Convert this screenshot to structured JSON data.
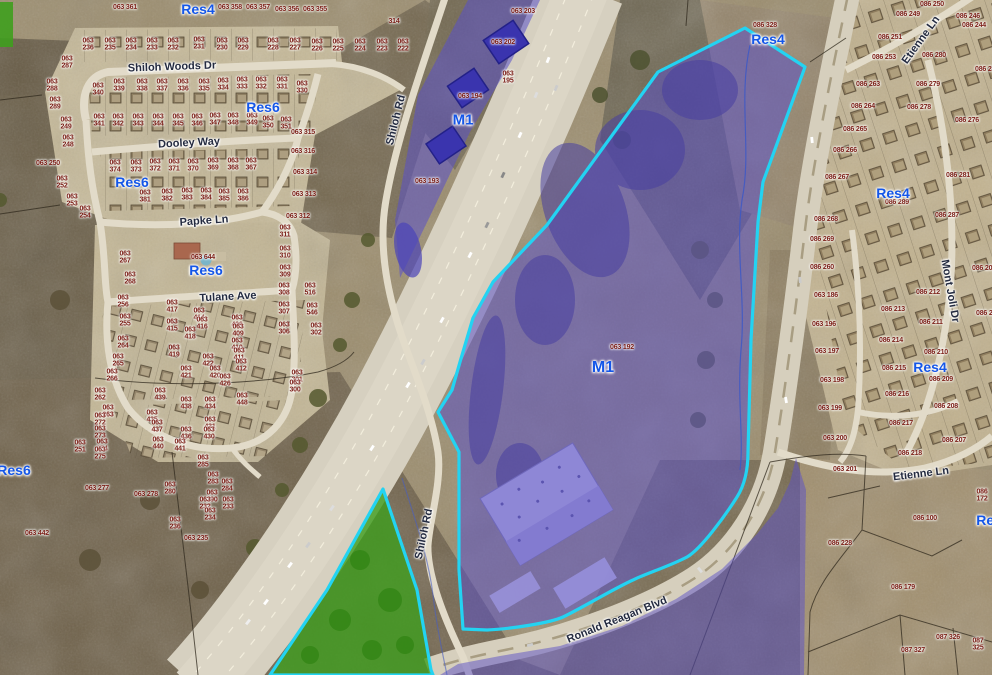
{
  "title": "Aerial parcel zoning map",
  "colors": {
    "selection_outline": "#23d3f2",
    "industrial_overlay": "#5a50c8",
    "greenspace_overlay": "#3f9e1e",
    "zone_label_blue": "#1456e8",
    "parcel_label_red": "#7c2018",
    "street_label_navy": "#242b40"
  },
  "map": {
    "zone_labels": [
      {
        "label": "Res4",
        "x": 198,
        "y": 9
      },
      {
        "label": "Res6",
        "x": 263,
        "y": 107
      },
      {
        "label": "Res6",
        "x": 132,
        "y": 182
      },
      {
        "label": "Res6",
        "x": 206,
        "y": 270
      },
      {
        "label": "Res6",
        "x": 14,
        "y": 470
      },
      {
        "label": "Res4",
        "x": 768,
        "y": 39
      },
      {
        "label": "Res4",
        "x": 893,
        "y": 193
      },
      {
        "label": "Res4",
        "x": 930,
        "y": 367
      },
      {
        "label": "Res4",
        "x": 993,
        "y": 520
      },
      {
        "label": "M1",
        "x": 463,
        "y": 120,
        "s": 15
      },
      {
        "label": "M1",
        "x": 603,
        "y": 368,
        "s": 16
      }
    ],
    "street_labels": [
      {
        "name": "Shiloh Woods Dr",
        "x": 172,
        "y": 67,
        "rot": -2
      },
      {
        "name": "Dooley Way",
        "x": 189,
        "y": 143,
        "rot": -3
      },
      {
        "name": "Papke Ln",
        "x": 204,
        "y": 221,
        "rot": -4
      },
      {
        "name": "Tulane Ave",
        "x": 228,
        "y": 297,
        "rot": -3
      },
      {
        "name": "Shiloh Rd",
        "x": 396,
        "y": 120,
        "rot": -76
      },
      {
        "name": "Shiloh Rd",
        "x": 424,
        "y": 534,
        "rot": -78
      },
      {
        "name": "Ronald Reagan Blvd",
        "x": 617,
        "y": 620,
        "rot": -22
      },
      {
        "name": "Etienne Ln",
        "x": 921,
        "y": 40,
        "rot": -54
      },
      {
        "name": "Etienne Ln",
        "x": 921,
        "y": 474,
        "rot": -7
      },
      {
        "name": "Mont Joli Dr",
        "x": 950,
        "y": 291,
        "rot": 80
      }
    ],
    "parcel_labels": [
      {
        "id": "063 361",
        "x": 125,
        "y": 8
      },
      {
        "id": "063 358",
        "x": 230,
        "y": 8
      },
      {
        "id": "063 357",
        "x": 258,
        "y": 8
      },
      {
        "id": "063 356",
        "x": 287,
        "y": 10
      },
      {
        "id": "063 355",
        "x": 315,
        "y": 10
      },
      {
        "id": "314",
        "x": 394,
        "y": 22
      },
      {
        "id": "063 203",
        "x": 523,
        "y": 12
      },
      {
        "id": "063 236",
        "x": 88,
        "y": 45,
        "w": 1
      },
      {
        "id": "063 235",
        "x": 110,
        "y": 45,
        "w": 1
      },
      {
        "id": "063 234",
        "x": 131,
        "y": 45,
        "w": 1
      },
      {
        "id": "063 233",
        "x": 152,
        "y": 45,
        "w": 1
      },
      {
        "id": "063 232",
        "x": 173,
        "y": 45,
        "w": 1
      },
      {
        "id": "063 231",
        "x": 199,
        "y": 44,
        "w": 1
      },
      {
        "id": "063 230",
        "x": 222,
        "y": 45,
        "w": 1
      },
      {
        "id": "063 229",
        "x": 243,
        "y": 45,
        "w": 1
      },
      {
        "id": "063 228",
        "x": 273,
        "y": 45,
        "w": 1
      },
      {
        "id": "063 227",
        "x": 295,
        "y": 45,
        "w": 1
      },
      {
        "id": "063 226",
        "x": 317,
        "y": 46,
        "w": 1
      },
      {
        "id": "063 225",
        "x": 338,
        "y": 46,
        "w": 1
      },
      {
        "id": "063 224",
        "x": 360,
        "y": 46,
        "w": 1
      },
      {
        "id": "063 223",
        "x": 382,
        "y": 46,
        "w": 1
      },
      {
        "id": "063 222",
        "x": 403,
        "y": 46,
        "w": 1
      },
      {
        "id": "063 315",
        "x": 303,
        "y": 133
      },
      {
        "id": "063 316",
        "x": 303,
        "y": 152
      },
      {
        "id": "063 314",
        "x": 305,
        "y": 173
      },
      {
        "id": "063 313",
        "x": 304,
        "y": 195
      },
      {
        "id": "063 312",
        "x": 298,
        "y": 217
      },
      {
        "id": "063 340",
        "x": 98,
        "y": 90,
        "w": 1
      },
      {
        "id": "063 339",
        "x": 119,
        "y": 86,
        "w": 1
      },
      {
        "id": "063 338",
        "x": 142,
        "y": 86,
        "w": 1
      },
      {
        "id": "063 337",
        "x": 162,
        "y": 86,
        "w": 1
      },
      {
        "id": "063 336",
        "x": 183,
        "y": 86,
        "w": 1
      },
      {
        "id": "063 335",
        "x": 204,
        "y": 86,
        "w": 1
      },
      {
        "id": "063 334",
        "x": 223,
        "y": 85,
        "w": 1
      },
      {
        "id": "063 333",
        "x": 242,
        "y": 84,
        "w": 1
      },
      {
        "id": "063 332",
        "x": 261,
        "y": 84,
        "w": 1
      },
      {
        "id": "063 331",
        "x": 282,
        "y": 84,
        "w": 1
      },
      {
        "id": "063 330",
        "x": 302,
        "y": 88,
        "w": 1
      },
      {
        "id": "063 341",
        "x": 99,
        "y": 121,
        "w": 1
      },
      {
        "id": "063 342",
        "x": 118,
        "y": 121,
        "w": 1
      },
      {
        "id": "063 343",
        "x": 138,
        "y": 121,
        "w": 1
      },
      {
        "id": "063 344",
        "x": 158,
        "y": 121,
        "w": 1
      },
      {
        "id": "063 345",
        "x": 178,
        "y": 121,
        "w": 1
      },
      {
        "id": "063 346",
        "x": 197,
        "y": 121,
        "w": 1
      },
      {
        "id": "063 347",
        "x": 215,
        "y": 120,
        "w": 1
      },
      {
        "id": "063 348",
        "x": 233,
        "y": 120,
        "w": 1
      },
      {
        "id": "063 349",
        "x": 252,
        "y": 120,
        "w": 1
      },
      {
        "id": "063 350",
        "x": 268,
        "y": 123,
        "w": 1
      },
      {
        "id": "063 351",
        "x": 286,
        "y": 124,
        "w": 1
      },
      {
        "id": "063 374",
        "x": 115,
        "y": 167,
        "w": 1
      },
      {
        "id": "063 373",
        "x": 136,
        "y": 167,
        "w": 1
      },
      {
        "id": "063 372",
        "x": 155,
        "y": 166,
        "w": 1
      },
      {
        "id": "063 371",
        "x": 174,
        "y": 166,
        "w": 1
      },
      {
        "id": "063 370",
        "x": 193,
        "y": 166,
        "w": 1
      },
      {
        "id": "063 369",
        "x": 213,
        "y": 165,
        "w": 1
      },
      {
        "id": "063 368",
        "x": 233,
        "y": 165,
        "w": 1
      },
      {
        "id": "063 367",
        "x": 251,
        "y": 165,
        "w": 1
      },
      {
        "id": "063 381",
        "x": 145,
        "y": 197,
        "w": 1
      },
      {
        "id": "063 382",
        "x": 167,
        "y": 196,
        "w": 1
      },
      {
        "id": "063 383",
        "x": 187,
        "y": 195,
        "w": 1
      },
      {
        "id": "063 384",
        "x": 206,
        "y": 195,
        "w": 1
      },
      {
        "id": "063 385",
        "x": 224,
        "y": 196,
        "w": 1
      },
      {
        "id": "063 386",
        "x": 243,
        "y": 196,
        "w": 1
      },
      {
        "id": "063 287",
        "x": 67,
        "y": 63,
        "w": 1
      },
      {
        "id": "063 288",
        "x": 52,
        "y": 86,
        "w": 1
      },
      {
        "id": "063 289",
        "x": 55,
        "y": 104,
        "w": 1
      },
      {
        "id": "063 249",
        "x": 66,
        "y": 124,
        "w": 1
      },
      {
        "id": "063 248",
        "x": 68,
        "y": 142,
        "w": 1
      },
      {
        "id": "063 250",
        "x": 48,
        "y": 164
      },
      {
        "id": "063 252",
        "x": 62,
        "y": 183,
        "w": 1
      },
      {
        "id": "063 253",
        "x": 72,
        "y": 201,
        "w": 1
      },
      {
        "id": "063 254",
        "x": 85,
        "y": 213,
        "w": 1
      },
      {
        "id": "063 644",
        "x": 203,
        "y": 258
      },
      {
        "id": "063 311",
        "x": 285,
        "y": 232,
        "w": 1
      },
      {
        "id": "063 310",
        "x": 285,
        "y": 253,
        "w": 1
      },
      {
        "id": "063 309",
        "x": 285,
        "y": 272,
        "w": 1
      },
      {
        "id": "063 308",
        "x": 284,
        "y": 290,
        "w": 1
      },
      {
        "id": "063 307",
        "x": 284,
        "y": 309,
        "w": 1
      },
      {
        "id": "063 306",
        "x": 284,
        "y": 329,
        "w": 1
      },
      {
        "id": "063 516",
        "x": 310,
        "y": 290,
        "w": 1
      },
      {
        "id": "063 546",
        "x": 312,
        "y": 310,
        "w": 1
      },
      {
        "id": "063 302",
        "x": 316,
        "y": 330,
        "w": 1
      },
      {
        "id": "063 301",
        "x": 297,
        "y": 377,
        "w": 1
      },
      {
        "id": "063 300",
        "x": 295,
        "y": 387,
        "w": 1
      },
      {
        "id": "063 267",
        "x": 125,
        "y": 258,
        "w": 1
      },
      {
        "id": "063 268",
        "x": 130,
        "y": 279,
        "w": 1
      },
      {
        "id": "063 256",
        "x": 123,
        "y": 302,
        "w": 1
      },
      {
        "id": "063 255",
        "x": 125,
        "y": 321,
        "w": 1
      },
      {
        "id": "063 264",
        "x": 123,
        "y": 343,
        "w": 1
      },
      {
        "id": "063 265",
        "x": 118,
        "y": 361,
        "w": 1
      },
      {
        "id": "063 266",
        "x": 112,
        "y": 376,
        "w": 1
      },
      {
        "id": "063 417",
        "x": 172,
        "y": 307,
        "w": 1
      },
      {
        "id": "063 414",
        "x": 199,
        "y": 315,
        "w": 1
      },
      {
        "id": "063 415",
        "x": 172,
        "y": 326,
        "w": 1
      },
      {
        "id": "063 416",
        "x": 202,
        "y": 324,
        "w": 1
      },
      {
        "id": "063 418",
        "x": 190,
        "y": 334,
        "w": 1
      },
      {
        "id": "063 406",
        "x": 237,
        "y": 322,
        "w": 1
      },
      {
        "id": "063 409",
        "x": 238,
        "y": 331,
        "w": 1
      },
      {
        "id": "063 410",
        "x": 237,
        "y": 345,
        "w": 1
      },
      {
        "id": "063 411",
        "x": 239,
        "y": 355,
        "w": 1
      },
      {
        "id": "063 412",
        "x": 241,
        "y": 366,
        "w": 1
      },
      {
        "id": "063 419",
        "x": 174,
        "y": 352,
        "w": 1
      },
      {
        "id": "063 422",
        "x": 208,
        "y": 361,
        "w": 1
      },
      {
        "id": "063 421",
        "x": 186,
        "y": 373,
        "w": 1
      },
      {
        "id": "063 420",
        "x": 215,
        "y": 373,
        "w": 1
      },
      {
        "id": "063 426",
        "x": 225,
        "y": 381,
        "w": 1
      },
      {
        "id": "063 439",
        "x": 160,
        "y": 395,
        "w": 1
      },
      {
        "id": "063 438",
        "x": 186,
        "y": 404,
        "w": 1
      },
      {
        "id": "063 434",
        "x": 210,
        "y": 404,
        "w": 1
      },
      {
        "id": "063 448",
        "x": 242,
        "y": 400,
        "w": 1
      },
      {
        "id": "063 435",
        "x": 152,
        "y": 417,
        "w": 1
      },
      {
        "id": "063 431",
        "x": 210,
        "y": 424,
        "w": 1
      },
      {
        "id": "063 437",
        "x": 157,
        "y": 427,
        "w": 1
      },
      {
        "id": "063 436",
        "x": 186,
        "y": 434,
        "w": 1
      },
      {
        "id": "063 430",
        "x": 209,
        "y": 434,
        "w": 1
      },
      {
        "id": "063 440",
        "x": 158,
        "y": 444,
        "w": 1
      },
      {
        "id": "063 441",
        "x": 180,
        "y": 446,
        "w": 1
      },
      {
        "id": "063 262",
        "x": 100,
        "y": 395,
        "w": 1
      },
      {
        "id": "063 263",
        "x": 108,
        "y": 412,
        "w": 1
      },
      {
        "id": "063 272",
        "x": 100,
        "y": 420,
        "w": 1
      },
      {
        "id": "063 273",
        "x": 100,
        "y": 433,
        "w": 1
      },
      {
        "id": "063 274",
        "x": 102,
        "y": 446,
        "w": 1
      },
      {
        "id": "063 251",
        "x": 80,
        "y": 447,
        "w": 1
      },
      {
        "id": "063 275",
        "x": 100,
        "y": 454,
        "w": 1
      },
      {
        "id": "063 277",
        "x": 97,
        "y": 489
      },
      {
        "id": "063 278",
        "x": 146,
        "y": 495
      },
      {
        "id": "063 280",
        "x": 170,
        "y": 489,
        "w": 1
      },
      {
        "id": "063 285",
        "x": 203,
        "y": 462,
        "w": 1
      },
      {
        "id": "063 283",
        "x": 213,
        "y": 479,
        "w": 1
      },
      {
        "id": "063 284",
        "x": 227,
        "y": 486,
        "w": 1
      },
      {
        "id": "063 290",
        "x": 212,
        "y": 497,
        "w": 1
      },
      {
        "id": "063 232",
        "x": 205,
        "y": 504,
        "w": 1
      },
      {
        "id": "063 233",
        "x": 228,
        "y": 504,
        "w": 1
      },
      {
        "id": "063 234",
        "x": 210,
        "y": 515,
        "w": 1
      },
      {
        "id": "063 235",
        "x": 196,
        "y": 539
      },
      {
        "id": "063 236",
        "x": 175,
        "y": 524,
        "w": 1
      },
      {
        "id": "063 442",
        "x": 37,
        "y": 534
      },
      {
        "id": "063 202",
        "x": 503,
        "y": 43
      },
      {
        "id": "063 195",
        "x": 508,
        "y": 78,
        "w": 1
      },
      {
        "id": "063 194",
        "x": 470,
        "y": 97
      },
      {
        "id": "063 193",
        "x": 427,
        "y": 182
      },
      {
        "id": "063 192",
        "x": 622,
        "y": 348
      },
      {
        "id": "086 328",
        "x": 765,
        "y": 26
      },
      {
        "id": "086 251",
        "x": 890,
        "y": 38
      },
      {
        "id": "086 253",
        "x": 884,
        "y": 58
      },
      {
        "id": "086 263",
        "x": 868,
        "y": 85
      },
      {
        "id": "086 264",
        "x": 863,
        "y": 107
      },
      {
        "id": "086 265",
        "x": 855,
        "y": 130
      },
      {
        "id": "086 266",
        "x": 845,
        "y": 151
      },
      {
        "id": "086 267",
        "x": 837,
        "y": 178
      },
      {
        "id": "086 268",
        "x": 826,
        "y": 220
      },
      {
        "id": "086 280",
        "x": 934,
        "y": 56
      },
      {
        "id": "086 279",
        "x": 928,
        "y": 85
      },
      {
        "id": "086 278",
        "x": 919,
        "y": 108
      },
      {
        "id": "086 276",
        "x": 967,
        "y": 121
      },
      {
        "id": "086 281",
        "x": 958,
        "y": 176
      },
      {
        "id": "086 289",
        "x": 897,
        "y": 203
      },
      {
        "id": "086 287",
        "x": 947,
        "y": 216
      },
      {
        "id": "086 250",
        "x": 932,
        "y": 5
      },
      {
        "id": "086 249",
        "x": 908,
        "y": 15
      },
      {
        "id": "086 246",
        "x": 968,
        "y": 17
      },
      {
        "id": "086 244",
        "x": 974,
        "y": 26
      },
      {
        "id": "086 245",
        "x": 987,
        "y": 70
      },
      {
        "id": "086 269",
        "x": 822,
        "y": 240
      },
      {
        "id": "086 260",
        "x": 822,
        "y": 268
      },
      {
        "id": "063 186",
        "x": 826,
        "y": 296
      },
      {
        "id": "063 196",
        "x": 824,
        "y": 325
      },
      {
        "id": "063 197",
        "x": 827,
        "y": 352
      },
      {
        "id": "063 198",
        "x": 832,
        "y": 381
      },
      {
        "id": "063 199",
        "x": 830,
        "y": 409
      },
      {
        "id": "063 200",
        "x": 835,
        "y": 439
      },
      {
        "id": "086 213",
        "x": 893,
        "y": 310
      },
      {
        "id": "086 212",
        "x": 928,
        "y": 293
      },
      {
        "id": "086 211",
        "x": 931,
        "y": 323
      },
      {
        "id": "086 214",
        "x": 891,
        "y": 341
      },
      {
        "id": "086 210",
        "x": 936,
        "y": 353
      },
      {
        "id": "086 215",
        "x": 894,
        "y": 369
      },
      {
        "id": "086 209",
        "x": 941,
        "y": 380
      },
      {
        "id": "086 216",
        "x": 897,
        "y": 395
      },
      {
        "id": "086 208",
        "x": 946,
        "y": 407
      },
      {
        "id": "086 217",
        "x": 901,
        "y": 424
      },
      {
        "id": "086 207",
        "x": 954,
        "y": 441
      },
      {
        "id": "086 205",
        "x": 984,
        "y": 269
      },
      {
        "id": "086 203",
        "x": 988,
        "y": 314
      },
      {
        "id": "086 218",
        "x": 910,
        "y": 454
      },
      {
        "id": "063 201",
        "x": 845,
        "y": 470
      },
      {
        "id": "086 100",
        "x": 925,
        "y": 519
      },
      {
        "id": "086 172",
        "x": 982,
        "y": 496,
        "w": 1
      },
      {
        "id": "086 228",
        "x": 840,
        "y": 544
      },
      {
        "id": "086 179",
        "x": 903,
        "y": 588
      },
      {
        "id": "087 326",
        "x": 948,
        "y": 638
      },
      {
        "id": "087 327",
        "x": 913,
        "y": 651
      },
      {
        "id": "087 325",
        "x": 978,
        "y": 645,
        "w": 1
      }
    ]
  }
}
